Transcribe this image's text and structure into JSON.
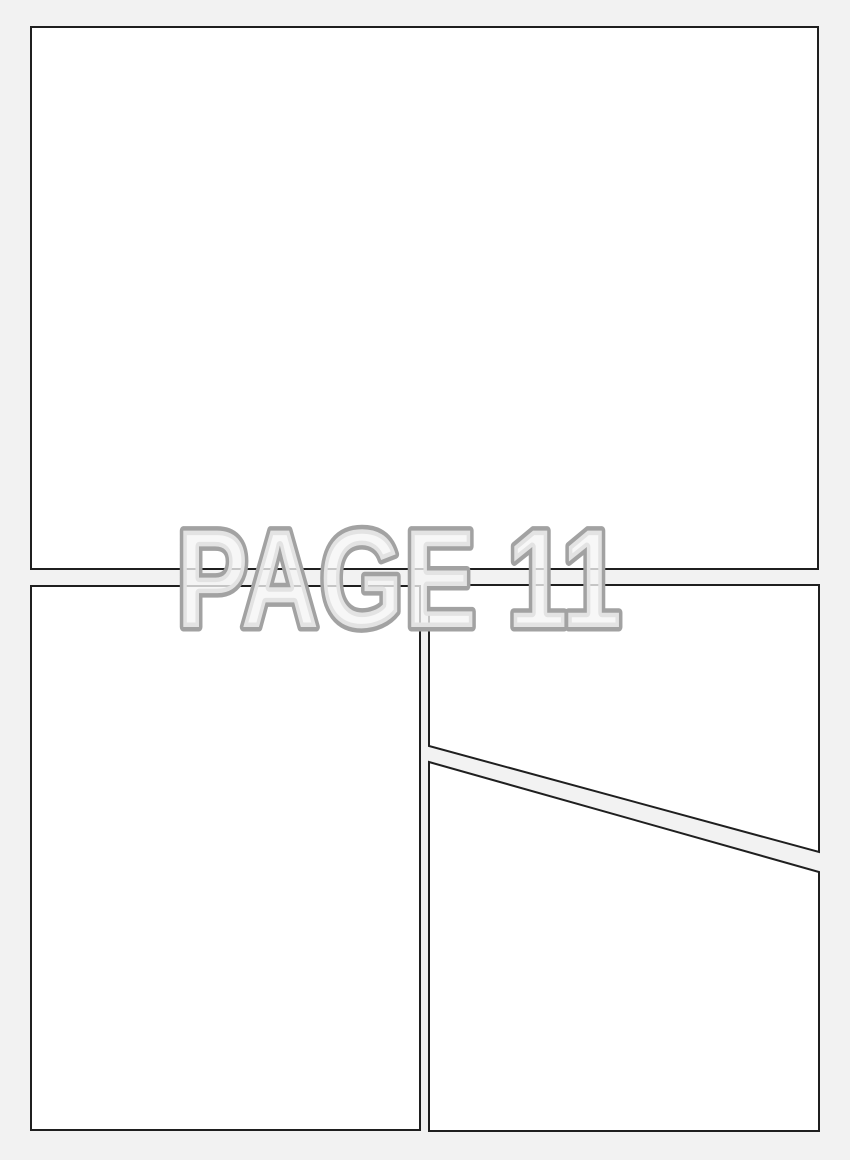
{
  "page": {
    "label": "PAGE 11"
  },
  "colors": {
    "page_background": "#f2f2f2",
    "panel_fill": "#ffffff",
    "panel_border": "#1f1f1f",
    "label_outline": "#a2a2a2",
    "label_fill": "#f5f5f5"
  },
  "panels": [
    {
      "id": "panel-1",
      "position": "top",
      "shape": "rectangle"
    },
    {
      "id": "panel-2",
      "position": "bottom-left",
      "shape": "rectangle"
    },
    {
      "id": "panel-3",
      "position": "bottom-right-upper",
      "shape": "quadrilateral-diagonal-bottom-edge"
    },
    {
      "id": "panel-4",
      "position": "bottom-right-lower",
      "shape": "quadrilateral-diagonal-top-edge"
    }
  ]
}
